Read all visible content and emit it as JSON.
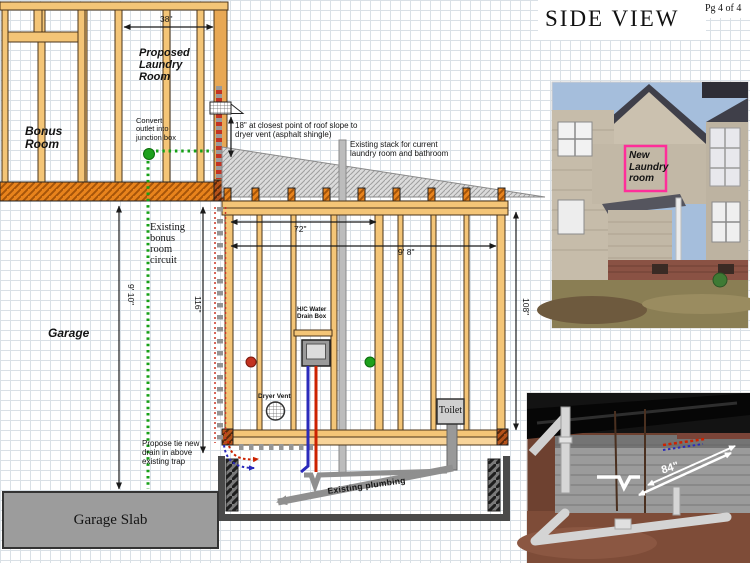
{
  "page": {
    "title": "SIDE VIEW",
    "page_number": "Pg 4 of 4"
  },
  "rooms": {
    "bonus": "Bonus\nRoom",
    "proposed_laundry": "Proposed\nLaundry\nRoom",
    "garage": "Garage",
    "garage_slab": "Garage Slab",
    "toilet": "Toilet"
  },
  "annotations": {
    "convert_outlet": "Convert\noutlet into\njunction box",
    "vent_clearance": "18\" at closest point of roof slope to\ndryer vent (asphalt shingle)",
    "existing_stack": "Existing stack for current\nlaundry room and bathroom",
    "existing_circuit": "Existing\nbonus\nroom\ncircuit",
    "hc_water_box": "H/C Water\nDrain Box",
    "dryer_vent": "Dryer Vent",
    "propose_tie": "Propose tie new\ndrain in above\nexisting trap",
    "existing_plumbing": "Existing plumbing"
  },
  "dimensions": {
    "wall_top": "38\"",
    "room_width_72": "72\"",
    "room_width_9_8": "9' 8\"",
    "room_height_108": "108\"",
    "garage_height_116": "116\"",
    "garage_height_9_10": "9' 10\"",
    "crawl_run_84": "84\""
  },
  "photos": {
    "house": {
      "caption": "New\nLaundry\nroom",
      "highlight_color": "#FF2E9A"
    },
    "crawlspace": {
      "dim_label": "84\""
    }
  },
  "colors": {
    "stud_tan": "#F4C577",
    "floor_orange": "#E8831C",
    "roof_gray": "#DBDBDB",
    "circuit_green": "#17A017",
    "hot_red": "#CC2200",
    "cold_blue": "#2A2ABB",
    "plumbing_gray": "#8F8F8F"
  }
}
